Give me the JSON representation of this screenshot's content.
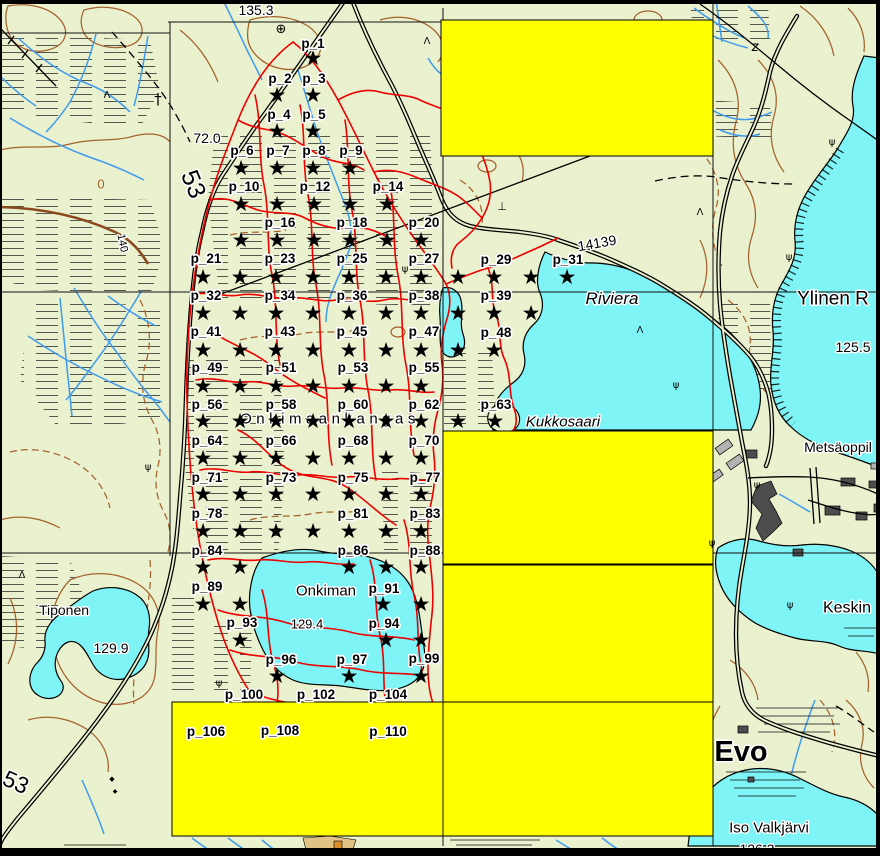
{
  "map": {
    "description": "Topographic GIS map view with sampling point grid p_1..p_110 and yellow highlight rectangles",
    "colors": {
      "background": "#EAF1CE",
      "water": "#7EF4F6",
      "contour": "#A5622D",
      "stream": "#3E9BEE",
      "trail_red": "#EE0000",
      "highlight": "#FFFF00",
      "road": "#000000",
      "building_dark": "#4D4D4D",
      "building_light": "#B3B3B3",
      "frame": "#000000",
      "tan_patch": "#E2C386",
      "orange_patch": "#D98C2C"
    },
    "masks": [
      {
        "x": 441,
        "y": 20,
        "w": 272,
        "h": 136
      },
      {
        "x": 443,
        "y": 431,
        "w": 270,
        "h": 133
      },
      {
        "x": 443,
        "y": 565,
        "w": 270,
        "h": 137
      },
      {
        "x": 172,
        "y": 702,
        "w": 541,
        "h": 134
      }
    ],
    "sample_points": {
      "marker_glyph": "★",
      "rows": [
        {
          "y": 58,
          "xs": [
            313
          ]
        },
        {
          "y": 95,
          "xs": [
            277,
            313
          ]
        },
        {
          "y": 131,
          "xs": [
            277,
            313
          ]
        },
        {
          "y": 168,
          "xs": [
            241,
            277,
            313,
            350
          ]
        },
        {
          "y": 204,
          "xs": [
            241,
            277,
            314,
            350,
            387
          ]
        },
        {
          "y": 240,
          "xs": [
            241,
            277,
            314,
            350,
            387,
            421
          ]
        },
        {
          "y": 277,
          "xs": [
            203,
            240,
            276,
            313,
            349,
            386,
            421,
            458,
            494,
            531,
            567
          ]
        },
        {
          "y": 313,
          "xs": [
            203,
            240,
            276,
            313,
            349,
            386,
            421,
            458,
            494,
            531
          ]
        },
        {
          "y": 350,
          "xs": [
            203,
            240,
            276,
            313,
            349,
            386,
            421,
            458,
            494
          ]
        },
        {
          "y": 386,
          "xs": [
            203,
            240,
            276,
            313,
            349,
            386,
            421
          ]
        },
        {
          "y": 421,
          "xs": [
            203,
            240,
            276,
            313,
            349,
            386,
            421,
            458,
            495
          ]
        },
        {
          "y": 458,
          "xs": [
            203,
            240,
            276,
            313,
            349,
            386,
            421
          ]
        },
        {
          "y": 494,
          "xs": [
            203,
            240,
            276,
            313,
            349,
            386,
            421
          ]
        },
        {
          "y": 531,
          "xs": [
            203,
            240,
            276,
            313,
            349,
            386,
            421
          ]
        },
        {
          "y": 567,
          "xs": [
            203,
            240,
            349,
            386,
            421
          ]
        },
        {
          "y": 604,
          "xs": [
            203,
            240,
            383,
            421
          ]
        },
        {
          "y": 640,
          "xs": [
            240,
            386,
            421
          ]
        },
        {
          "y": 676,
          "xs": [
            277,
            349,
            421
          ]
        }
      ],
      "labels": [
        [
          "p_1",
          313,
          43
        ],
        [
          "p_2",
          280,
          78
        ],
        [
          "p_3",
          314,
          78
        ],
        [
          "p_4",
          279,
          114
        ],
        [
          "p_5",
          314,
          114
        ],
        [
          "p_6",
          242,
          150
        ],
        [
          "p_7",
          278,
          150
        ],
        [
          "p_8",
          314,
          150
        ],
        [
          "p_9",
          351,
          150
        ],
        [
          "p_10",
          244,
          186
        ],
        [
          "p_12",
          315,
          186
        ],
        [
          "p_14",
          388,
          186
        ],
        [
          "p_16",
          280,
          222
        ],
        [
          "p_18",
          352,
          222
        ],
        [
          "p_20",
          424,
          222
        ],
        [
          "p_21",
          206,
          258
        ],
        [
          "p_23",
          280,
          258
        ],
        [
          "p_25",
          352,
          258
        ],
        [
          "p_27",
          424,
          258
        ],
        [
          "p_29",
          496,
          259
        ],
        [
          "p_31",
          568,
          259
        ],
        [
          "p_32",
          206,
          295
        ],
        [
          "p_34",
          280,
          295
        ],
        [
          "p_36",
          352,
          295
        ],
        [
          "p_38",
          424,
          295
        ],
        [
          "p_39",
          496,
          295
        ],
        [
          "p_41",
          206,
          331
        ],
        [
          "p_43",
          280,
          331
        ],
        [
          "p_45",
          352,
          331
        ],
        [
          "p_47",
          424,
          331
        ],
        [
          "p_48",
          496,
          332
        ],
        [
          "p_49",
          207,
          367
        ],
        [
          "p_51",
          281,
          367
        ],
        [
          "p_53",
          353,
          367
        ],
        [
          "p_55",
          424,
          367
        ],
        [
          "p_56",
          207,
          404
        ],
        [
          "p_58",
          281,
          404
        ],
        [
          "p_60",
          353,
          404
        ],
        [
          "p_62",
          424,
          404
        ],
        [
          "p_63",
          496,
          404
        ],
        [
          "p_64",
          207,
          440
        ],
        [
          "p_66",
          281,
          440
        ],
        [
          "p_68",
          353,
          440
        ],
        [
          "p_70",
          424,
          440
        ],
        [
          "p_71",
          207,
          477
        ],
        [
          "p_73",
          281,
          477
        ],
        [
          "p_75",
          353,
          477
        ],
        [
          "p_77",
          425,
          477
        ],
        [
          "p_78",
          207,
          513
        ],
        [
          "p_81",
          353,
          513
        ],
        [
          "p_83",
          425,
          513
        ],
        [
          "p_84",
          207,
          550
        ],
        [
          "p_86",
          353,
          550
        ],
        [
          "p_88",
          425,
          550
        ],
        [
          "p_89",
          207,
          586
        ],
        [
          "p_91",
          384,
          588
        ],
        [
          "p_93",
          242,
          622
        ],
        [
          "p_94",
          384,
          623
        ],
        [
          "p_96",
          281,
          659
        ],
        [
          "p_97",
          352,
          659
        ],
        [
          "p_99",
          424,
          658
        ],
        [
          "p_100",
          244,
          694
        ],
        [
          "p_102",
          316,
          694
        ],
        [
          "p_104",
          388,
          694
        ],
        [
          "p_106",
          206,
          731
        ],
        [
          "p_108",
          280,
          730
        ],
        [
          "p_110",
          388,
          731
        ]
      ]
    },
    "map_labels": [
      {
        "t": "135.3",
        "x": 256,
        "y": 10,
        "s": 14
      },
      {
        "t": "72.0",
        "x": 207,
        "y": 138,
        "s": 14
      },
      {
        "t": "53",
        "x": 194,
        "y": 184,
        "s": 25,
        "r": 68
      },
      {
        "t": "53",
        "x": 16,
        "y": 782,
        "s": 23,
        "r": 24
      },
      {
        "t": "0",
        "x": 101,
        "y": 184,
        "s": 13,
        "c": "#A5622D"
      },
      {
        "t": "140",
        "x": 123,
        "y": 243,
        "s": 11,
        "r": 78
      },
      {
        "t": "14139",
        "x": 597,
        "y": 243,
        "s": 14,
        "r": -10
      },
      {
        "t": "Riviera",
        "x": 612,
        "y": 298,
        "s": 17,
        "it": 1,
        "se": 1
      },
      {
        "t": "Kukkosaari",
        "x": 563,
        "y": 421,
        "s": 15,
        "it": 1
      },
      {
        "t": "Ylinen R",
        "x": 833,
        "y": 298,
        "s": 19
      },
      {
        "t": "125.5",
        "x": 853,
        "y": 347,
        "s": 14
      },
      {
        "t": "Metsäoppil",
        "x": 838,
        "y": 447,
        "s": 14
      },
      {
        "t": "Keskin",
        "x": 847,
        "y": 607,
        "s": 16
      },
      {
        "t": "Evo",
        "x": 741,
        "y": 751,
        "s": 29,
        "w": "600"
      },
      {
        "t": "Iso Valkjärvi",
        "x": 769,
        "y": 827,
        "s": 15
      },
      {
        "t": "126.3",
        "x": 757,
        "y": 849,
        "s": 14
      },
      {
        "t": "Tiponen",
        "x": 64,
        "y": 610,
        "s": 14
      },
      {
        "t": "129.9",
        "x": 111,
        "y": 648,
        "s": 14
      },
      {
        "t": "Onkiman",
        "x": 326,
        "y": 590,
        "s": 15
      },
      {
        "t": "129.4",
        "x": 307,
        "y": 624,
        "s": 13
      },
      {
        "t": "Onkimaankangas",
        "x": 330,
        "y": 418,
        "s": 15,
        "sp": 4.5
      }
    ],
    "symbols": [
      {
        "g": "⊕",
        "x": 281,
        "y": 33,
        "s": 13,
        "n": "circle-cross-icon"
      },
      {
        "g": "†",
        "x": 158,
        "y": 104,
        "s": 15,
        "n": "mast-icon"
      },
      {
        "g": "⊥",
        "x": 502,
        "y": 210,
        "s": 11,
        "n": "monument-icon"
      },
      {
        "g": "◆",
        "x": 112,
        "y": 781,
        "s": 7,
        "n": "cairn-icon"
      },
      {
        "g": "◆",
        "x": 115,
        "y": 793,
        "s": 6,
        "n": "cairn-icon"
      },
      {
        "g": "z",
        "x": 755,
        "y": 51,
        "s": 13,
        "it": 1,
        "n": "gate-icon"
      }
    ],
    "tufts": [
      [
        405,
        272
      ],
      [
        789,
        260
      ],
      [
        832,
        145
      ],
      [
        676,
        388
      ],
      [
        757,
        488
      ],
      [
        712,
        546
      ],
      [
        790,
        608
      ],
      [
        219,
        686
      ],
      [
        148,
        470
      ]
    ],
    "trees": [
      [
        427,
        44
      ],
      [
        700,
        215
      ],
      [
        22,
        578
      ],
      [
        107,
        98
      ],
      [
        640,
        333
      ]
    ]
  }
}
